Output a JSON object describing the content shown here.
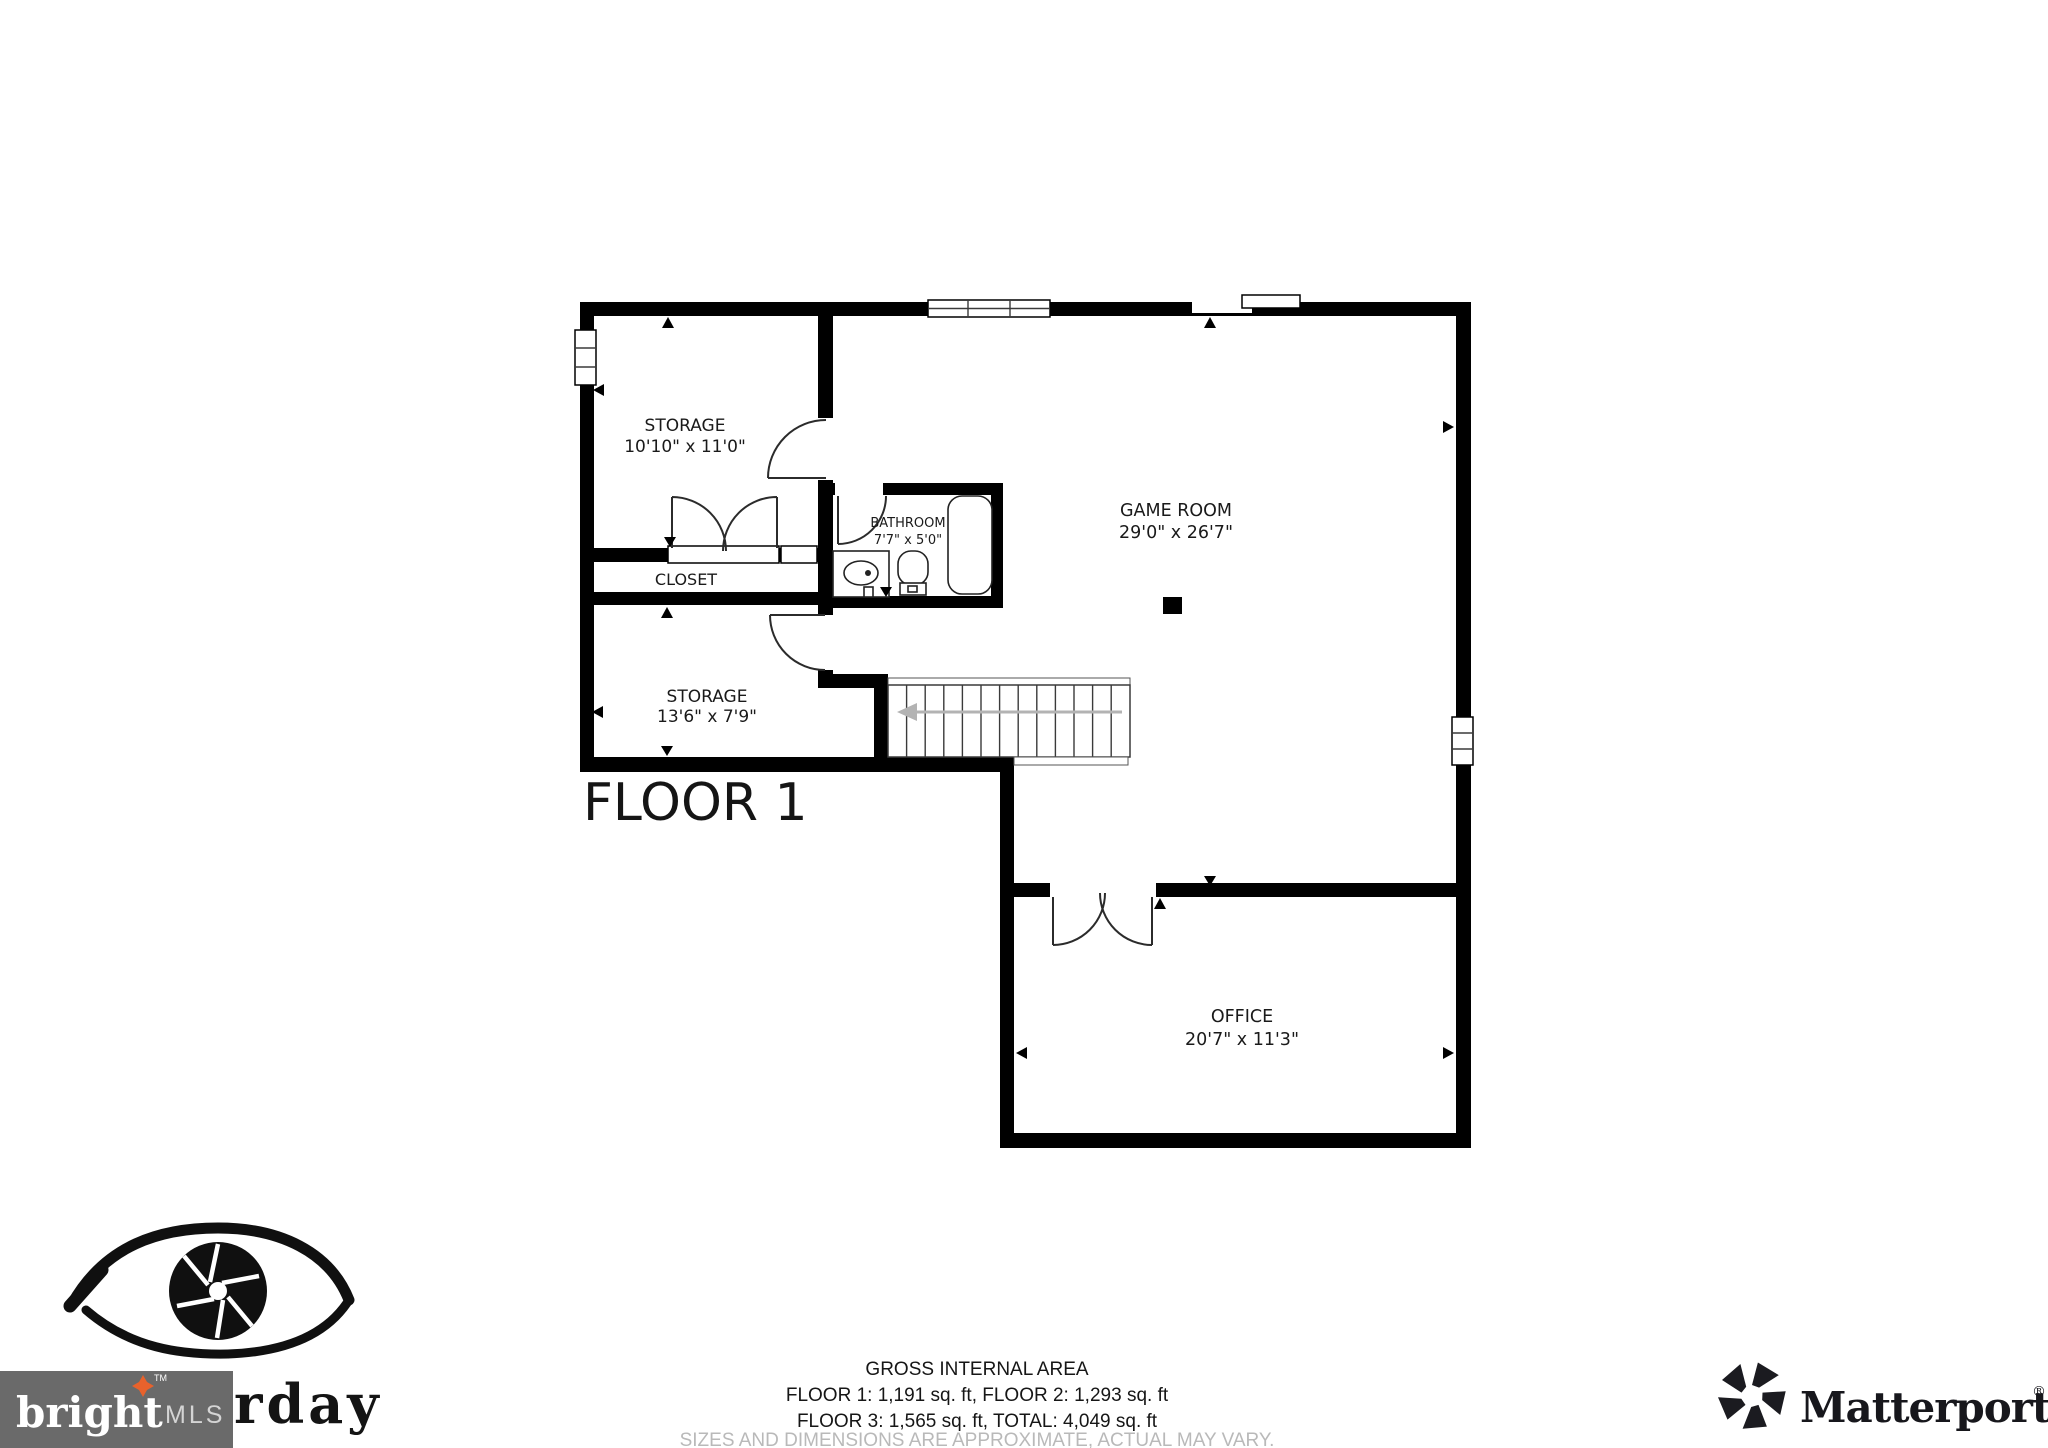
{
  "plan": {
    "title": "FLOOR 1",
    "rooms": {
      "storage_upper": {
        "name": "STORAGE",
        "dims": "10'10\" x 11'0\""
      },
      "closet": {
        "name": "CLOSET"
      },
      "bathroom": {
        "name": "BATHROOM",
        "dims": "7'7\" x 5'0\""
      },
      "game_room": {
        "name": "GAME ROOM",
        "dims": "29'0\" x 26'7\""
      },
      "storage_lower": {
        "name": "STORAGE",
        "dims": "13'6\" x 7'9\""
      },
      "office": {
        "name": "OFFICE",
        "dims": "20'7\" x 11'3\""
      }
    }
  },
  "footer": {
    "heading": "GROSS INTERNAL AREA",
    "areas_line_1": "FLOOR 1: 1,191 sq. ft, FLOOR 2: 1,293 sq. ft",
    "areas_line_2": "FLOOR 3: 1,565 sq. ft, TOTAL: 4,049 sq. ft",
    "disclaimer": "SIZES AND DIMENSIONS ARE APPROXIMATE, ACTUAL MAY VARY."
  },
  "logos": {
    "bright_mls": {
      "word": "bright",
      "tm": "TM",
      "suffix": "MLS"
    },
    "photographer_watermark": {
      "visible_text": "rday"
    },
    "matterport": {
      "word": "Matterport",
      "registered": "®"
    }
  },
  "colors": {
    "wall": "#000000",
    "stair_arrow": "#b3b3b3",
    "disclaimer_text": "#b9b9b9",
    "bright_box": "#6a6a6a",
    "bright_star": "#e8622c"
  }
}
